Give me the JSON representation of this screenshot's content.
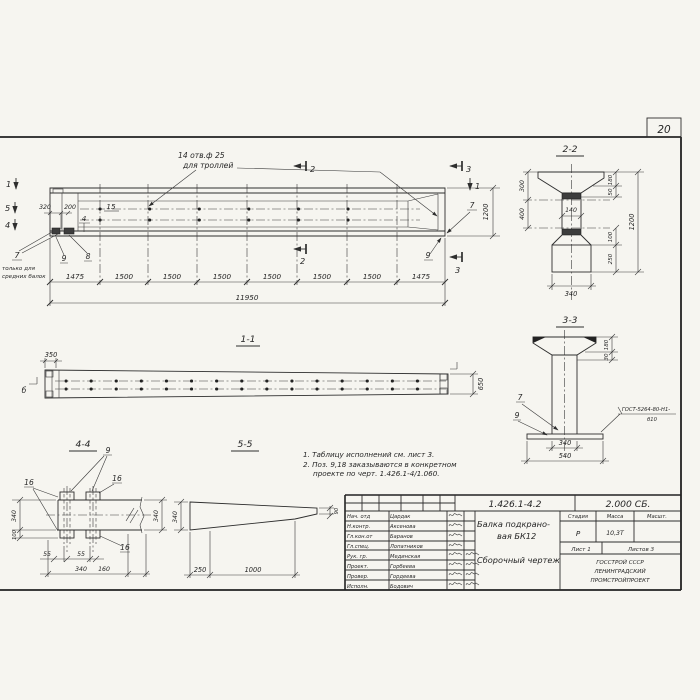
{
  "page": {
    "number": "20"
  },
  "views": {
    "main": {
      "note1": "14 отв.ф 25",
      "note2": "для троллей",
      "c1": "1",
      "c2": "2",
      "c3": "3",
      "c4": "4",
      "c5": "5",
      "d320": "320",
      "d200": "200",
      "p15": "15",
      "p7": "7",
      "p8": "8",
      "p9": "9",
      "fn1": "только для",
      "fn2": "средних балок",
      "d1200": "1200",
      "chain": [
        "1475",
        "1500",
        "1500",
        "1500",
        "1500",
        "1500",
        "1500",
        "1475"
      ],
      "total": "11950"
    },
    "s11": {
      "title": "1-1",
      "d350": "350",
      "d650": "650",
      "mb": "б"
    },
    "s22": {
      "title": "2-2",
      "d300": "300",
      "d400": "400",
      "d140": "140",
      "d180": "180",
      "d50": "50",
      "d100": "100",
      "d250": "250",
      "d1200": "1200",
      "d340": "340"
    },
    "s33": {
      "title": "3-3",
      "d180": "180",
      "d30": "30",
      "p7": "7",
      "p9": "9",
      "w1": "ГОСТ-5264-80-Н1-",
      "w2": "б10",
      "d340": "340",
      "d540": "540"
    },
    "s44": {
      "title": "4-4",
      "p9": "9",
      "p16": "16",
      "d340": "340",
      "d100": "100",
      "d55": "55",
      "d160": "160"
    },
    "s55": {
      "title": "5-5",
      "d340": "340",
      "d90": "90",
      "d250": "250",
      "d1000": "1000"
    }
  },
  "notes": [
    "1. Таблицу исполнений см. лист 3.",
    "2. Поз. 9,18 заказываются в конкретном",
    "проекте по черт. 1.426.1-4/1.060."
  ],
  "tb": {
    "doc_number": "1.426.1-4.2",
    "series": "2.000 СБ.",
    "title1": "Балка подкрано-",
    "title2": "вая БК12",
    "title3": "Сборочный чертеж",
    "stage_h": "Стадия",
    "mass_h": "Масса",
    "scale_h": "Масшт.",
    "stage": "Р",
    "mass": "10,3Т",
    "sheet": "Лист 1",
    "sheets": "Листов 3",
    "org1": "ГОССТРОЙ СССР",
    "org2": "ЛЕНИНГРАДСКИЙ",
    "org3": "ПРОМСТРОЙПРОЕКТ",
    "rows": [
      {
        "role": "Нач. отд",
        "name": "Цардак"
      },
      {
        "role": "Н.контр.",
        "name": "Аксенова"
      },
      {
        "role": "Гл.кон.от",
        "name": "Баранов"
      },
      {
        "role": "Гл.спец.",
        "name": "Лопатников"
      },
      {
        "role": "Рук. гр.",
        "name": "Мединская"
      },
      {
        "role": "Проект.",
        "name": "Горбеева"
      },
      {
        "role": "Провер.",
        "name": "Гордеева"
      },
      {
        "role": "Исполн.",
        "name": "Бодович"
      }
    ]
  }
}
